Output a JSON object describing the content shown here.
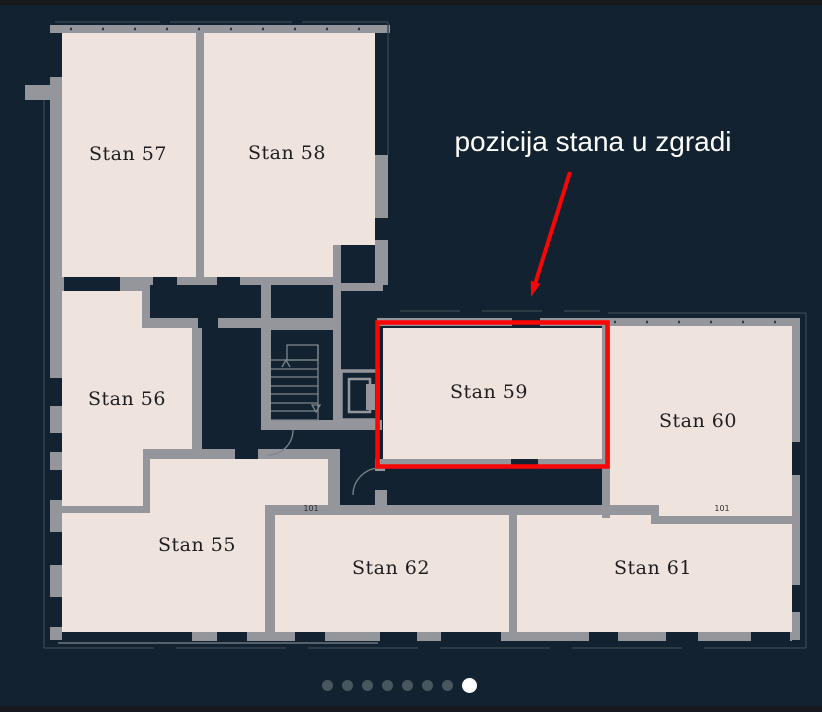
{
  "annotation": {
    "text": "pozicija stana u zgradi"
  },
  "highlight": {
    "room": "Stan 59"
  },
  "rooms": [
    {
      "id": "stan-55",
      "label": "Stan 55"
    },
    {
      "id": "stan-56",
      "label": "Stan 56"
    },
    {
      "id": "stan-57",
      "label": "Stan 57"
    },
    {
      "id": "stan-58",
      "label": "Stan 58"
    },
    {
      "id": "stan-59",
      "label": "Stan 59",
      "highlighted": true
    },
    {
      "id": "stan-60",
      "label": "Stan 60"
    },
    {
      "id": "stan-61",
      "label": "Stan 61"
    },
    {
      "id": "stan-62",
      "label": "Stan 62"
    }
  ],
  "plan": {
    "door_labels": [
      "101",
      "101"
    ]
  },
  "carousel": {
    "dot_count": 8,
    "active_index": 7
  },
  "colors": {
    "background": "#122230",
    "frame_strip": "#17191d",
    "room_fill": "#eee4dd",
    "wall": "#95969c",
    "outline": "#35424e",
    "detail": "#7e868d",
    "label": "#1d1d20",
    "highlight": "#fb0505",
    "annotation_text": "#ffffff",
    "dot": "#48565f",
    "dot_active": "#ffffff"
  }
}
